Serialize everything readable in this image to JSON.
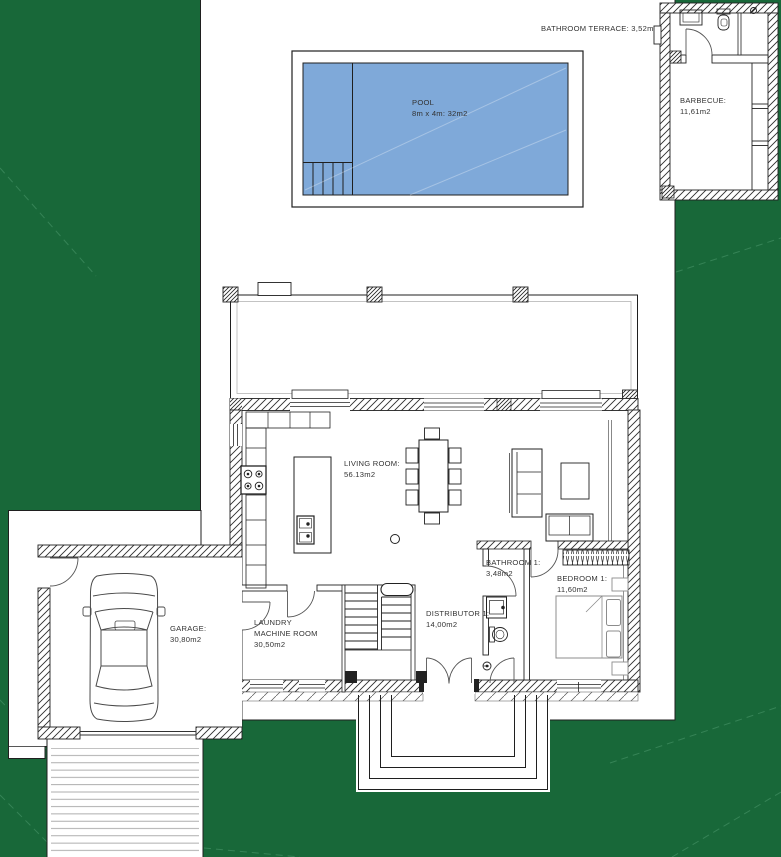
{
  "document": {
    "type": "architectural-floor-plan",
    "view": "site plan with ground floor"
  },
  "rooms": {
    "bathroom_terrace": {
      "label": "BATHROOM TERRACE: 3,52m2"
    },
    "pool": {
      "name": "POOL",
      "size": "8m x 4m: 32m2"
    },
    "barbecue": {
      "name": "BARBECUE:",
      "area": "11,61m2"
    },
    "living_room": {
      "name": "LIVING ROOM:",
      "area": "56.13m2"
    },
    "garage": {
      "name": "GARAGE:",
      "area": "30,80m2"
    },
    "laundry": {
      "line1": "LAUNDRY",
      "line2": "MACHINE ROOM",
      "area": "30,50m2"
    },
    "distributor": {
      "name": "DISTRIBUTOR 1:",
      "area": "14,00m2"
    },
    "bathroom1": {
      "name": "BATHROOM 1:",
      "area": "3,48m2"
    },
    "bedroom1": {
      "name": "BEDROOM 1:",
      "area": "11,60m2"
    }
  },
  "colors": {
    "background_green": "#186839",
    "contour_line_green": "#4e9a6e",
    "plot_white": "#ffffff",
    "pool_blue": "#7fa9d9",
    "line_dark": "#222222",
    "furniture_gray": "#8c8c8c"
  }
}
